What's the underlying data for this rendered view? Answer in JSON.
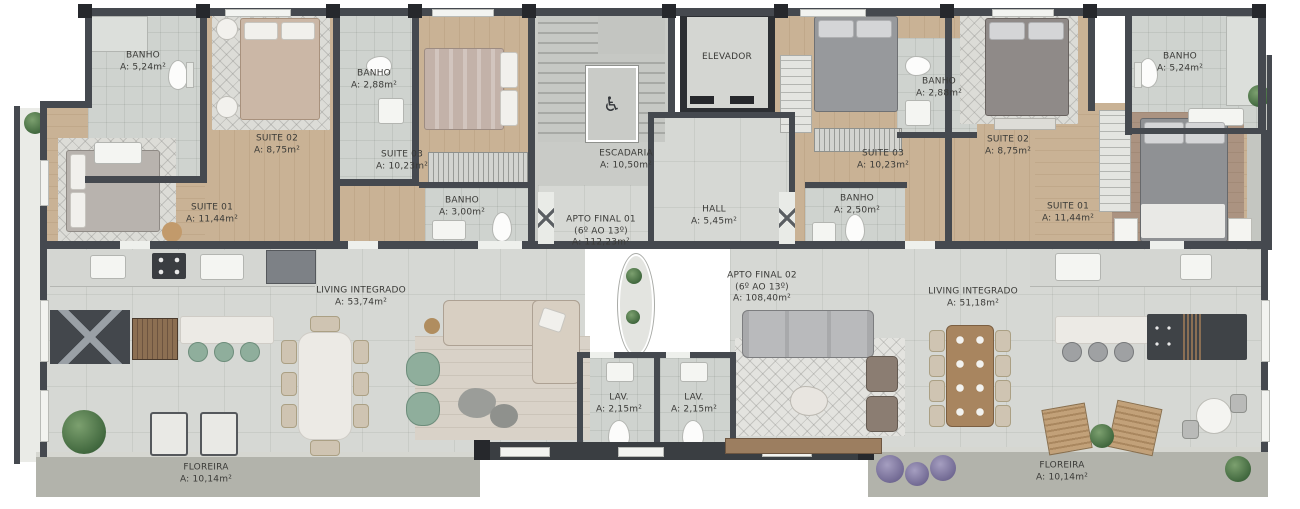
{
  "common": {
    "elevador": {
      "name": "ELEVADOR"
    },
    "escadaria": {
      "name": "ESCADARIA",
      "area": "A: 10,50m²"
    },
    "hall": {
      "name": "HALL",
      "area": "A: 5,45m²"
    }
  },
  "apto1": {
    "name": "APTO FINAL 01",
    "floors": "(6º AO 13º)",
    "area": "A: 112,23m²",
    "rooms": {
      "banho1": {
        "name": "BANHO",
        "area": "A: 5,24m²"
      },
      "suite02": {
        "name": "SUITE 02",
        "area": "A: 8,75m²"
      },
      "banho2": {
        "name": "BANHO",
        "area": "A: 2,88m²"
      },
      "suite03": {
        "name": "SUITE 03",
        "area": "A: 10,23m²"
      },
      "suite01": {
        "name": "SUITE 01",
        "area": "A: 11,44m²"
      },
      "banho3": {
        "name": "BANHO",
        "area": "A: 3,00m²"
      },
      "living": {
        "name": "LIVING INTEGRADO",
        "area": "A: 53,74m²"
      },
      "lav": {
        "name": "LAV.",
        "area": "A: 2,15m²"
      },
      "floreira": {
        "name": "FLOREIRA",
        "area": "A: 10,14m²"
      }
    }
  },
  "apto2": {
    "name": "APTO FINAL 02",
    "floors": "(6º AO 13º)",
    "area": "A: 108,40m²",
    "rooms": {
      "suite03": {
        "name": "SUITE 03",
        "area": "A: 10,23m²"
      },
      "banho1": {
        "name": "BANHO",
        "area": "A: 2,50m²"
      },
      "suite02": {
        "name": "SUITE 02",
        "area": "A: 8,75m²"
      },
      "banho2": {
        "name": "BANHO",
        "area": "A: 2,88m²"
      },
      "banho3": {
        "name": "BANHO",
        "area": "A: 5,24m²"
      },
      "suite01": {
        "name": "SUITE 01",
        "area": "A: 11,44m²"
      },
      "living": {
        "name": "LIVING INTEGRADO",
        "area": "A: 51,18m²"
      },
      "lav": {
        "name": "LAV.",
        "area": "A: 2,15m²"
      },
      "floreira": {
        "name": "FLOREIRA",
        "area": "A: 10,14m²"
      }
    }
  },
  "icons": {
    "accessible": "♿"
  },
  "colors": {
    "wall": "#45494f",
    "wood_floor": "#c9b295",
    "tile_floor": "#d6d8d4",
    "accent_green": "#8fae9c"
  }
}
